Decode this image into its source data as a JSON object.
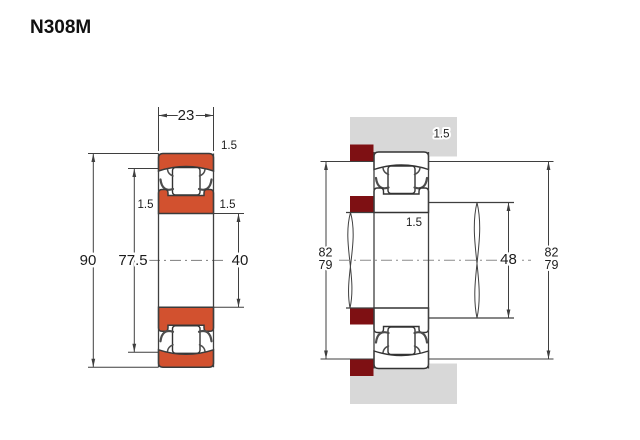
{
  "title": "N308M",
  "colors": {
    "bearing_ring_fill": "#d2512f",
    "abutment_spacer_fill": "#7e1013",
    "housing_fill": "#d8d8d8",
    "line": "#3f3f3f",
    "centerline": "#8c8c8c",
    "text": "#1c1c1c"
  },
  "left_view": {
    "width": "23",
    "outer_diameter": "90",
    "shoulder_diameter": "77.5",
    "bore_diameter": "40",
    "chamfer_top_right": "1.5",
    "chamfer_mid_left": "1.5",
    "chamfer_mid_right": "1.5"
  },
  "right_view": {
    "housing_fillet": "1.5",
    "shaft_fillet": "1.5",
    "abutment_left_upper": "82",
    "abutment_left_lower": "79",
    "abutment_right_upper": "82",
    "abutment_right_lower": "79",
    "shaft_shoulder_diameter": "48"
  }
}
